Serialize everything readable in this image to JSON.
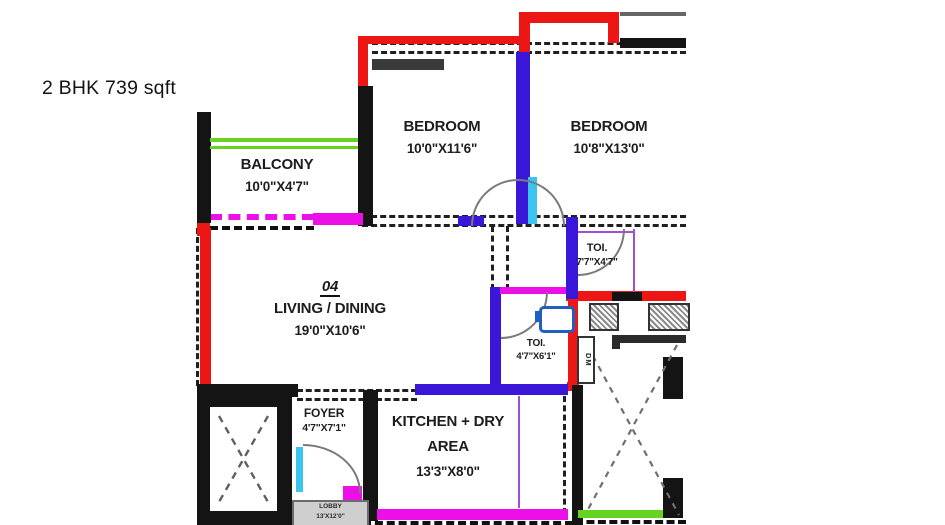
{
  "title": "2 BHK 739 sqft",
  "unit_number": "04",
  "rooms": {
    "balcony": {
      "name": "BALCONY",
      "dims": "10'0\"X4'7\""
    },
    "bedroom1": {
      "name": "BEDROOM",
      "dims": "10'0\"X11'6\""
    },
    "bedroom2": {
      "name": "BEDROOM",
      "dims": "10'8\"X13'0\""
    },
    "living_dining": {
      "name": "LIVING / DINING",
      "dims": "19'0\"X10'6\""
    },
    "toilet_right": {
      "name": "TOI.",
      "dims": "7'7\"X4'7\""
    },
    "toilet_mid": {
      "name": "TOI.",
      "dims": "4'7\"X6'1\""
    },
    "kitchen": {
      "name_line1": "KITCHEN + DRY",
      "name_line2": "AREA",
      "dims": "13'3\"X8'0\""
    },
    "foyer": {
      "name": "FOYER",
      "dims": "4'7\"X7'1\""
    },
    "lobby": {
      "name": "LOBBY",
      "dims": "13'X12'0\""
    },
    "duct": {
      "label": "DM"
    }
  },
  "colors": {
    "wall_black": "#141414",
    "accent_red": "#ee1515",
    "accent_blue": "#3a16d9",
    "accent_cyan": "#3ac4ee",
    "accent_magenta": "#ec0fe8",
    "accent_green": "#66d41f",
    "accent_violet": "#a04fd4"
  }
}
